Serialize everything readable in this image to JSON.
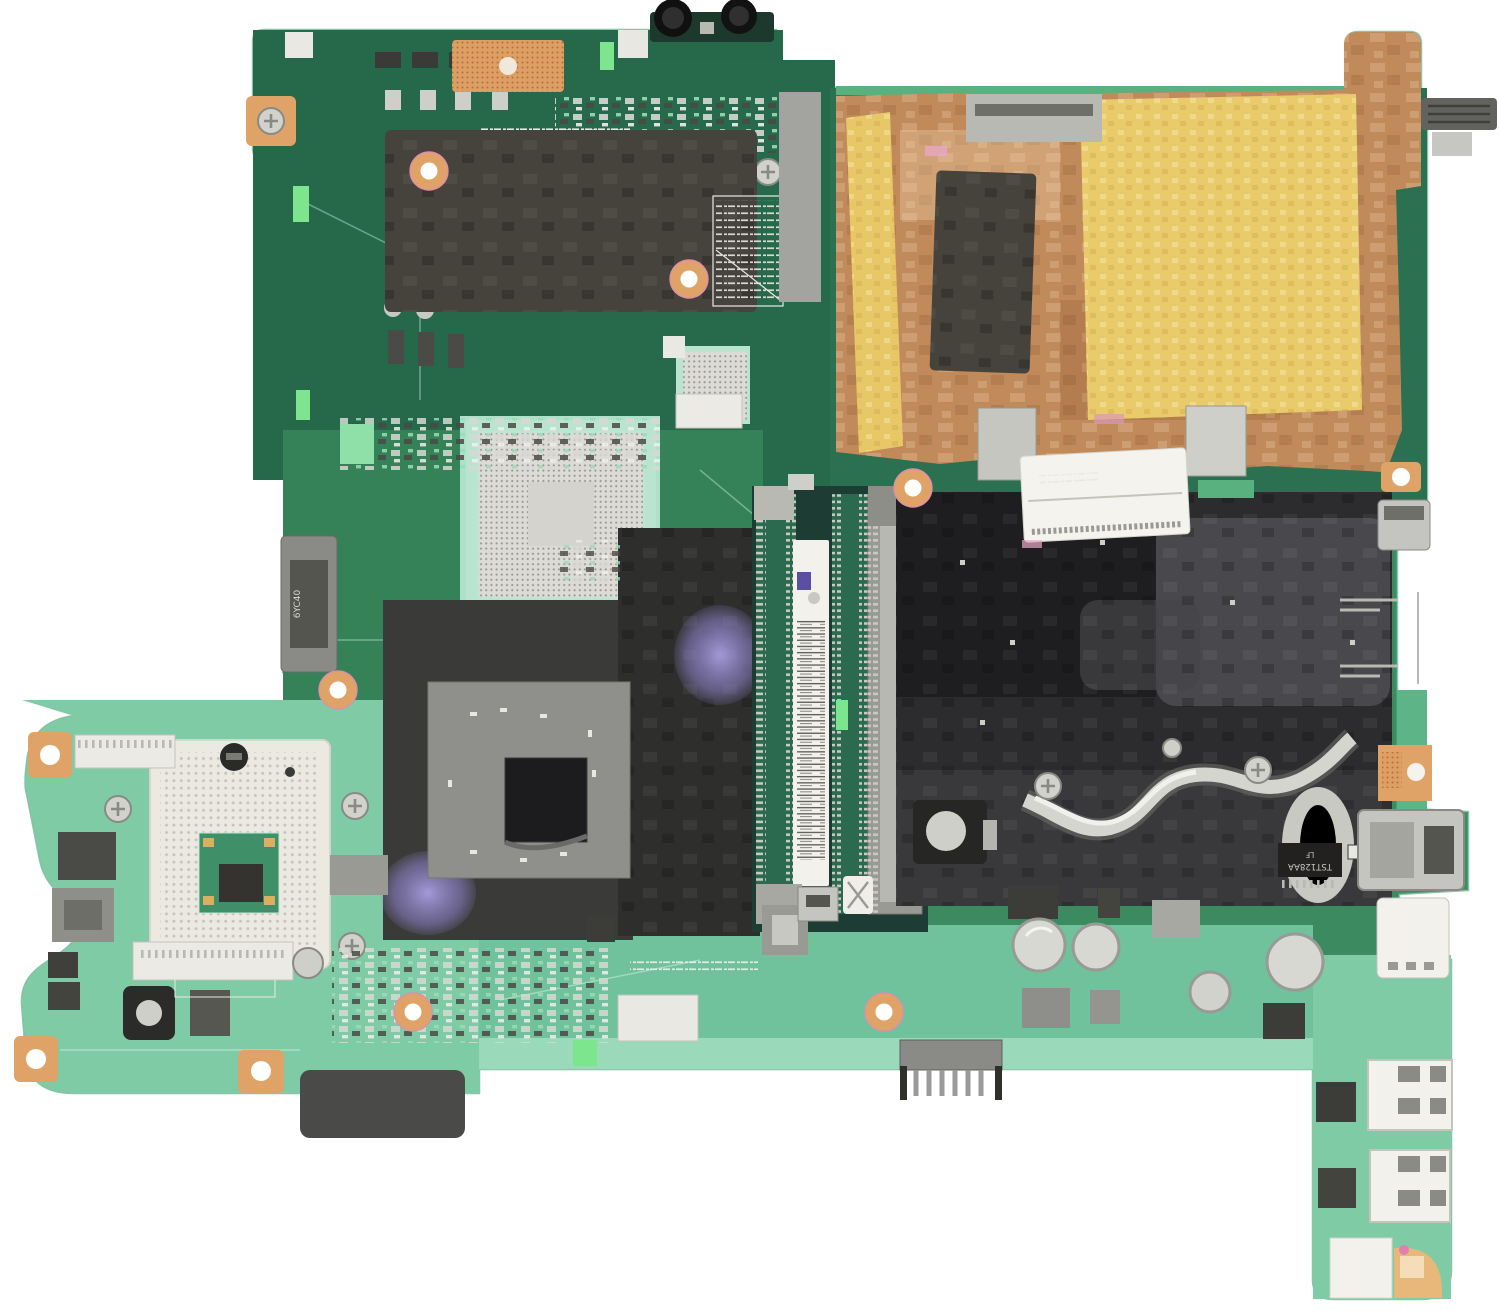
{
  "photo": {
    "subject": "laptop-motherboard-product-photo",
    "background_color": "#ffffff"
  },
  "palette": {
    "pcb_green_dark": "#25684a",
    "pcb_green_mid": "#3b8a60",
    "pcb_green_light": "#7fcba6",
    "pcb_green_pale": "#a9dfc5",
    "copper": "#c08a5a",
    "copper_light": "#d9ab7c",
    "kapton_gold": "#e9cb6b",
    "thermal_pad_dark": "#46423c",
    "black_film": "#2c2c2e",
    "mylar_silver": "#d5d5d0",
    "purple_sheen": "#a99ee0",
    "socket_cream": "#ece9e1",
    "pad_gray": "#d8d7d2",
    "metal_silver": "#c4c4c0",
    "solder_pad_orange": "#dfa368",
    "label_white": "#f2f1ec"
  },
  "silkscreen": {
    "edge_connector_label": "6YC40",
    "ic_label_line1": "TST128AA",
    "ic_label_line2": "LF"
  },
  "components": [
    {
      "name": "audio-jacks"
    },
    {
      "name": "copper-heat-spreader"
    },
    {
      "name": "kapton-tape-strip"
    },
    {
      "name": "kapton-tape-panel"
    },
    {
      "name": "thermal-pad-top-left"
    },
    {
      "name": "thermal-pad-on-copper"
    },
    {
      "name": "cpu-socket"
    },
    {
      "name": "bga-footprint"
    },
    {
      "name": "gpu-chip"
    },
    {
      "name": "sodimm-slot"
    },
    {
      "name": "black-film-shield"
    },
    {
      "name": "mylar-crinkle"
    },
    {
      "name": "zif-connector"
    },
    {
      "name": "usb-stack-port"
    },
    {
      "name": "usb-ports-bottom-tab"
    },
    {
      "name": "battery-pin-header"
    },
    {
      "name": "electrolytic-capacitors"
    },
    {
      "name": "edge-connector-left"
    },
    {
      "name": "screw-pads"
    }
  ]
}
